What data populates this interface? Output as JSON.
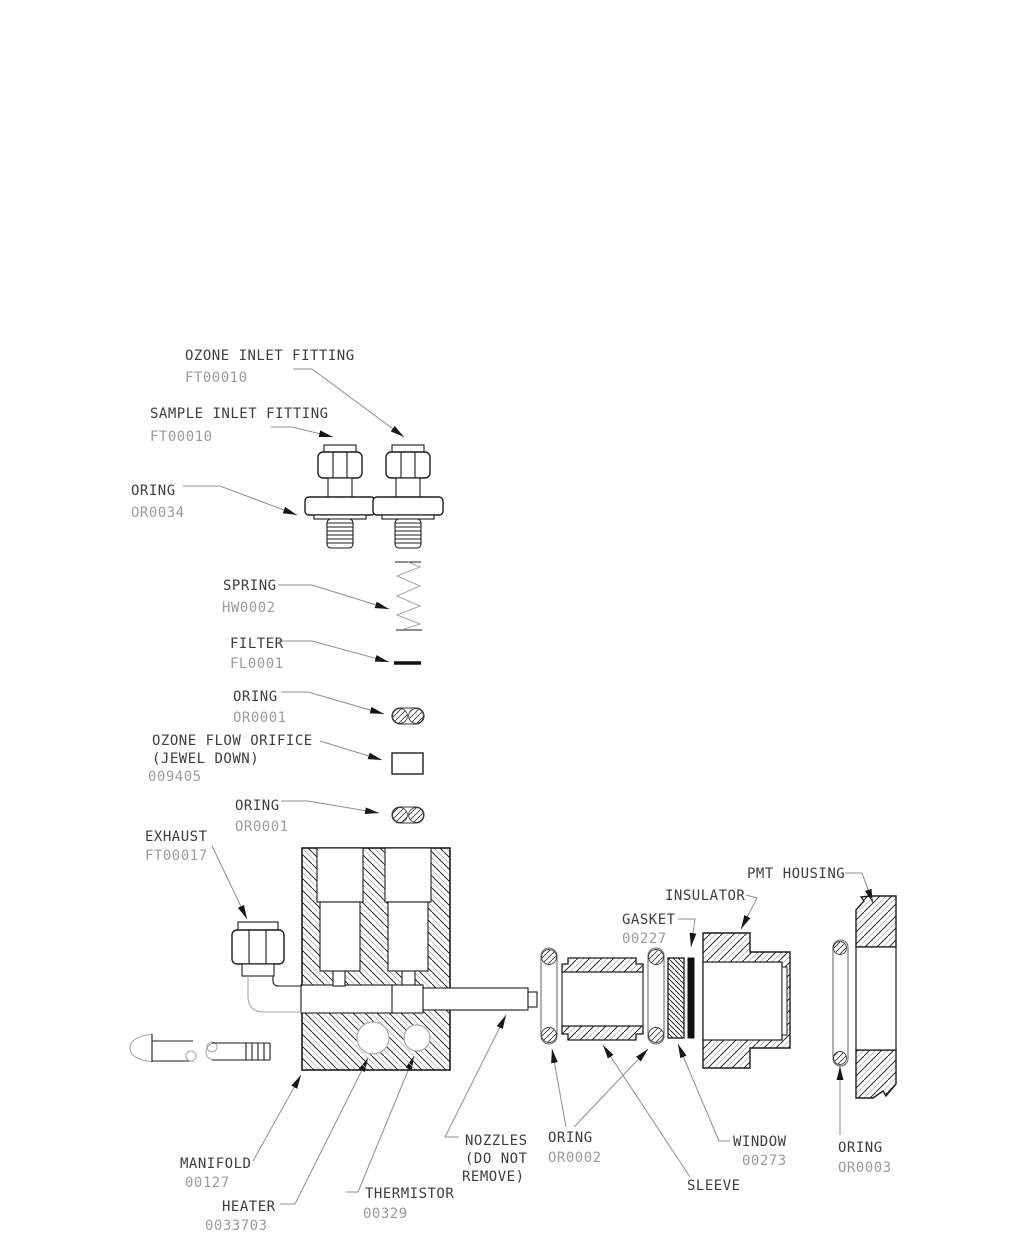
{
  "diagram": {
    "kind": "exploded-parts-diagram",
    "labels": {
      "ozone_inlet_fitting": {
        "line1": "OZONE INLET FITTING",
        "line2": "FT00010"
      },
      "sample_inlet_fitting": {
        "line1": "SAMPLE INLET FITTING",
        "line2": "FT00010"
      },
      "oring_or0034": {
        "line1": "ORING",
        "line2": "OR0034"
      },
      "spring": {
        "line1": "SPRING",
        "line2": "HW0002"
      },
      "filter": {
        "line1": "FILTER",
        "line2": "FL0001"
      },
      "oring_or0001_upper": {
        "line1": "ORING",
        "line2": "OR0001"
      },
      "ozone_flow_orifice": {
        "line1": "OZONE FLOW ORIFICE",
        "line2": "(JEWEL DOWN)",
        "line3": "009405"
      },
      "oring_or0001_lower": {
        "line1": "ORING",
        "line2": "OR0001"
      },
      "exhaust": {
        "line1": "EXHAUST",
        "line2": "FT00017"
      },
      "pmt_housing": {
        "line1": "PMT HOUSING"
      },
      "insulator": {
        "line1": "INSULATOR"
      },
      "gasket": {
        "line1": "GASKET",
        "line2": "00227"
      },
      "nozzles": {
        "line1": "NOZZLES",
        "line2": "(DO NOT",
        "line3": "REMOVE)"
      },
      "oring_or0002": {
        "line1": "ORING",
        "line2": "OR0002"
      },
      "sleeve": {
        "line1": "SLEEVE"
      },
      "window": {
        "line1": "WINDOW",
        "line2": "00273"
      },
      "oring_or0003": {
        "line1": "ORING",
        "line2": "OR0003"
      },
      "manifold": {
        "line1": "MANIFOLD",
        "line2": "00127"
      },
      "heater": {
        "line1": "HEATER",
        "line2": "0033703"
      },
      "thermistor": {
        "line1": "THERMISTOR",
        "line2": "00329"
      }
    }
  }
}
